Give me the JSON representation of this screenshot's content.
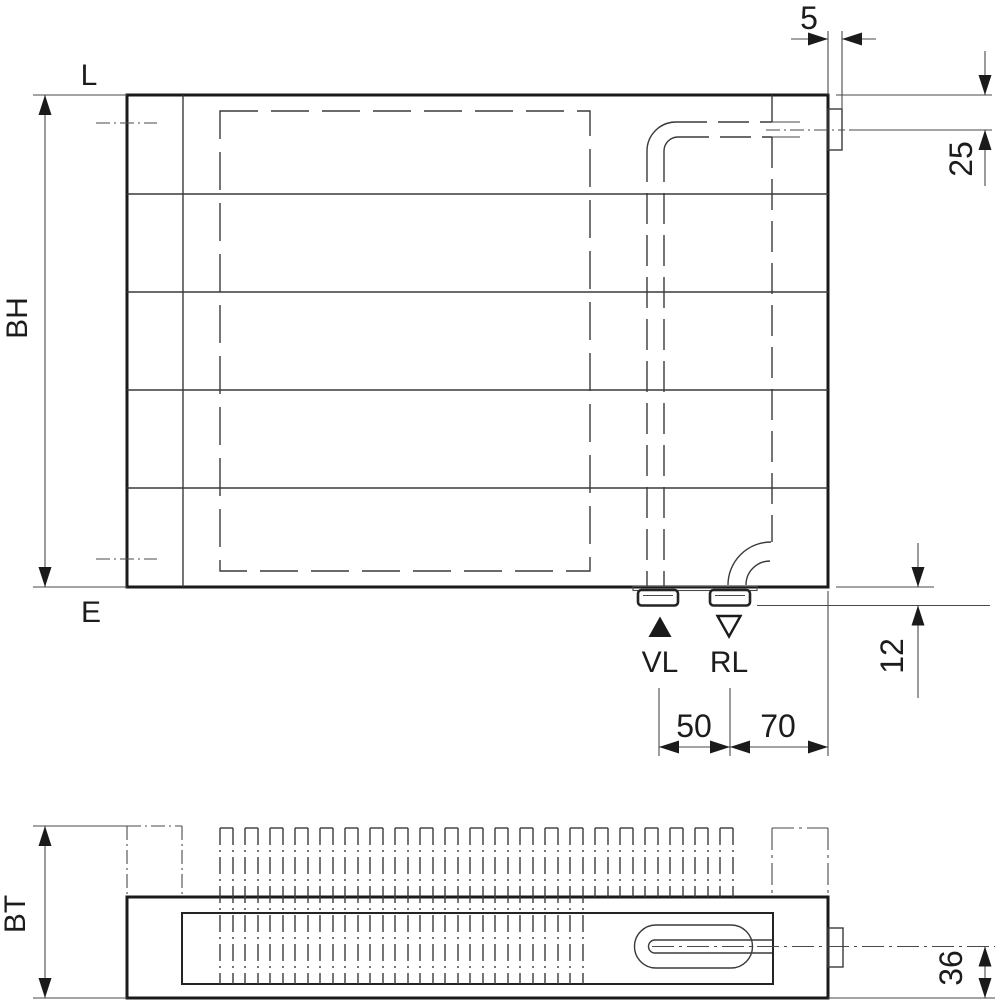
{
  "front_view": {
    "label_top": "L",
    "label_bottom": "E",
    "dim_height": "BH",
    "dim_tab_width": "5",
    "dim_top_offset": "25",
    "dim_bottom_offset": "12",
    "dim_spacing_vl_rl": "50",
    "dim_spacing_rl_edge": "70",
    "supply_label": "VL",
    "return_label": "RL"
  },
  "bottom_view": {
    "dim_depth": "BT",
    "dim_pipe_center": "36"
  },
  "colors": {
    "line": "#1c1c1c",
    "background": "#ffffff"
  }
}
